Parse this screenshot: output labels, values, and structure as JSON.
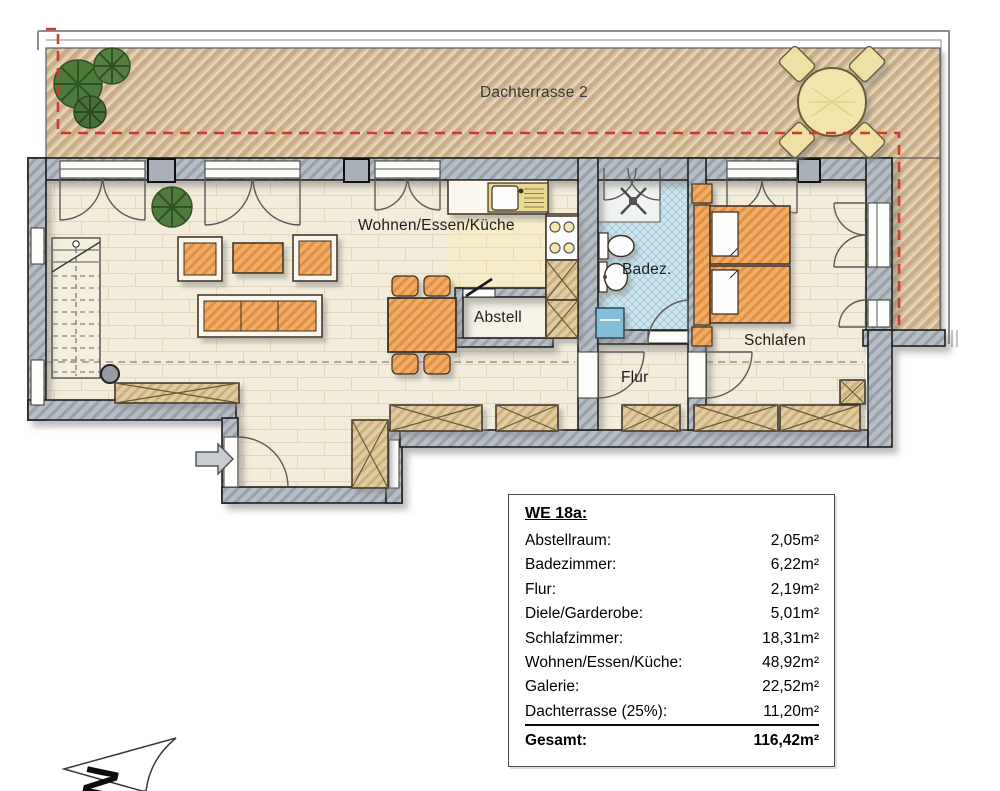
{
  "terrace": {
    "label": "Dachterrasse 2"
  },
  "rooms": {
    "living": "Wohnen/Essen/Küche",
    "bath": "Badez.",
    "storage": "Abstell",
    "hall": "Flur",
    "bedroom": "Schlafen"
  },
  "area_table": {
    "title": "WE 18a:",
    "rows": [
      {
        "label": "Abstellraum:",
        "value": "2,05m²"
      },
      {
        "label": "Badezimmer:",
        "value": "6,22m²"
      },
      {
        "label": "Flur:",
        "value": "2,19m²"
      },
      {
        "label": "Diele/Garderobe:",
        "value": "5,01m²"
      },
      {
        "label": "Schlafzimmer:",
        "value": "18,31m²"
      },
      {
        "label": "Wohnen/Essen/Küche:",
        "value": "48,92m²"
      },
      {
        "label": "Galerie:",
        "value": "22,52m²"
      },
      {
        "label": "Dachterrasse (25%):",
        "value": "11,20m²"
      }
    ],
    "total": {
      "label": "Gesamt:",
      "value": "116,42m²"
    }
  },
  "compass": {
    "north_label": "N"
  },
  "icons": {
    "plant": "plant-icon",
    "terrace_table": "terrace-table-icon",
    "entry_arrow": "entry-arrow-icon",
    "north_arrow": "north-arrow-icon"
  },
  "colors": {
    "terrace_boundary_dash": "#cf3b28",
    "wall_gray": "#b4bbc2",
    "terrace_tan": "#d8c2a2",
    "bath_blue": "#cfe6ee",
    "furniture_orange": "#f0ad69",
    "floor_cream": "#f3ecda"
  }
}
